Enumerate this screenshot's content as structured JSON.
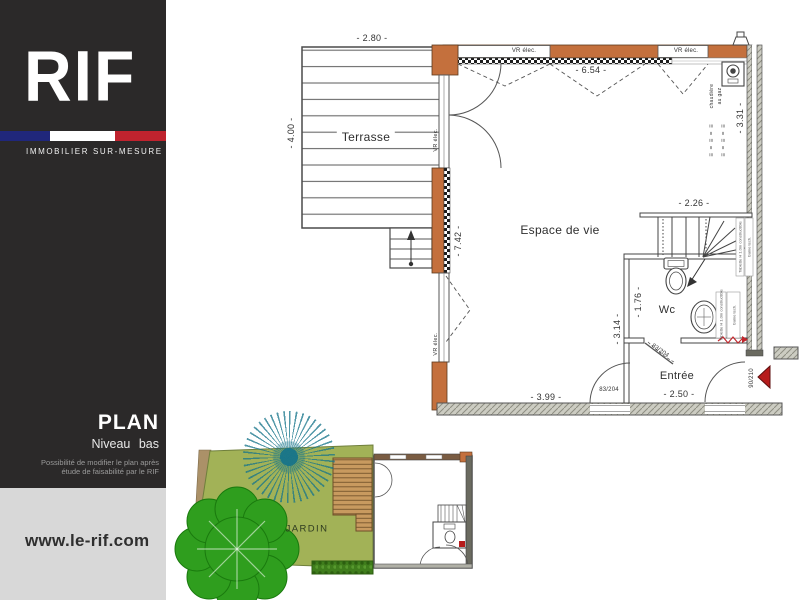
{
  "sidebar": {
    "logo": "RIF",
    "tagline": "IMMOBILIER  SUR-MESURE",
    "plan_title": "PLAN",
    "plan_subtitle": "Niveau bas",
    "note_line1": "Possibilité de modifier le plan après",
    "note_line2": "étude de faisabilité par le RIF",
    "website": "www.le-rif.com",
    "colors": {
      "background": "#2b2929",
      "flag_blue": "#20277b",
      "flag_red": "#bf232e",
      "footer_background": "#d8d8d8"
    }
  },
  "plan": {
    "rooms": {
      "terrace": "Terrasse",
      "living": "Espace de vie",
      "wc": "Wc",
      "entry": "Entrée",
      "garden": "JARDIN"
    },
    "dims": {
      "terrace_w": "- 2.80 -",
      "terrace_h": "- 4.00 -",
      "living_w": "- 6.54 -",
      "living_h": "- 7.42 -",
      "right_h": "- 3.31 -",
      "stair_w": "- 2.26 -",
      "wc_h": "- 1.76 -",
      "hall_h": "- 3.14 -",
      "living_bottom_w": "- 3.99 -",
      "entry_w": "- 2.50 -"
    },
    "labels": {
      "vr_elec": "VR élec.",
      "boiler_1": "chaudière",
      "boiler_2": "au gaz",
      "door_int": "83/204",
      "door_entry": "90/210",
      "note_shelf": "Tablette H 1.0m constructible",
      "note_duct": "Gaine tech.",
      "elec_sym": "≡ = ≡ = ≡"
    },
    "colors": {
      "wall_orange": "#c4703d",
      "party_wall": "#ccccc2",
      "garden_green": "#a2b257",
      "deck_wood": "#c89a5f",
      "tree_green": "#2f9e1e",
      "starburst_teal": "#17768c",
      "entry_arrow_red": "#b61c1c"
    }
  }
}
